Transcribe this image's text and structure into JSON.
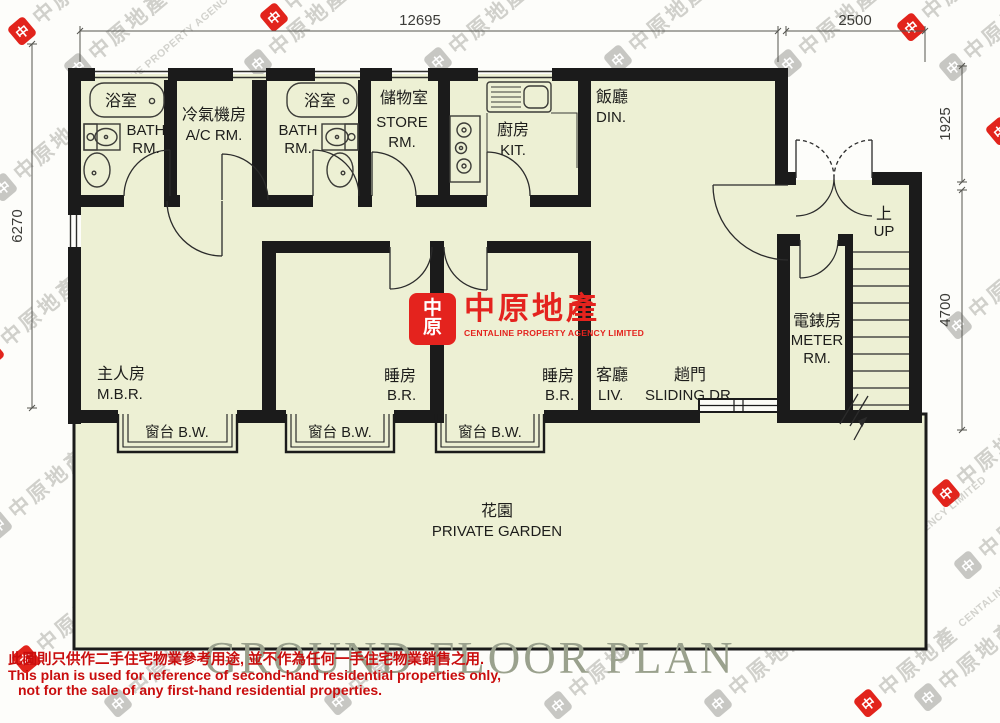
{
  "dimensions": {
    "top": "12695",
    "top_right": "2500",
    "right_upper": "1925",
    "right_lower": "4700",
    "left": "6270"
  },
  "rooms": {
    "bath1": {
      "zh": "浴室",
      "en_line1": "BATH",
      "en_line2": "RM."
    },
    "ac": {
      "zh": "冷氣機房",
      "en": "A/C RM."
    },
    "bath2": {
      "zh": "浴室",
      "en_line1": "BATH",
      "en_line2": "RM."
    },
    "store": {
      "zh": "儲物室",
      "en_line1": "STORE",
      "en_line2": "RM."
    },
    "kitchen": {
      "zh": "廚房",
      "en": "KIT."
    },
    "dining": {
      "zh": "飯廳",
      "en": "DIN."
    },
    "master_bedroom": {
      "zh": "主人房",
      "en": "M.B.R."
    },
    "bedroom1": {
      "zh": "睡房",
      "en": "B.R."
    },
    "bedroom2": {
      "zh": "睡房",
      "en": "B.R."
    },
    "living": {
      "zh": "客廳",
      "en": "LIV."
    },
    "sliding_door": {
      "zh": "趟門",
      "en": "SLIDING DR."
    },
    "meter": {
      "zh": "電錶房",
      "en_line1": "METER",
      "en_line2": "RM."
    },
    "stairs_up": {
      "zh": "上",
      "en": "UP"
    },
    "bay_window": {
      "label": "窗台 B.W."
    },
    "garden": {
      "zh": "花園",
      "en": "PRIVATE GARDEN"
    }
  },
  "logo": {
    "mark_line1": "中",
    "mark_line2": "原",
    "name_zh": "中原地產",
    "name_en": "CENTALINE PROPERTY AGENCY LIMITED"
  },
  "title": "GROUND FLOOR PLAN",
  "disclaimer": {
    "zh": "此圖則只供作二手住宅物業參考用途, 並不作為任何一手住宅物業銷售之用.",
    "en_line1": "This plan is used for reference of second-hand residential properties only,",
    "en_line2": "not for the sale of any first-hand residential properties."
  },
  "watermark": {
    "mark": "中",
    "zh": "中原地產",
    "en": "CENTALINE PROPERTY AGENCY LIMITED"
  },
  "colors": {
    "floor": "#edf0d4",
    "wall": "#1b1b1b",
    "brand_red": "#e4231e",
    "disclaimer_red": "#c90d0d",
    "title_gray": "#9aa18d"
  }
}
